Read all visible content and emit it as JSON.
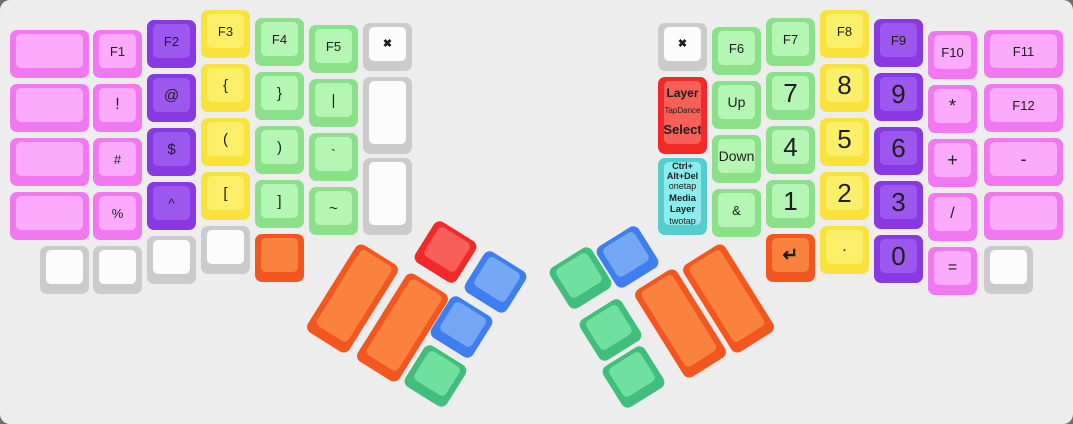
{
  "board": {
    "width": 1073,
    "height": 424,
    "bg": "#ededed",
    "page_bg": "#6e6e6e",
    "radius": 10,
    "legend_color": "#1e1e1e"
  },
  "palette": {
    "pink": {
      "outer": "#f178f1",
      "inner": "#fcaafc"
    },
    "purple": {
      "outer": "#8939e2",
      "inner": "#9c57ee"
    },
    "yellow": {
      "outer": "#f7e33b",
      "inner": "#fbef69"
    },
    "green": {
      "outer": "#8ae18a",
      "inner": "#b5f6b5"
    },
    "white": {
      "outer": "#cbcbcb",
      "inner": "#fcfcfc"
    },
    "orange": {
      "outer": "#f3561e",
      "inner": "#f8823e"
    },
    "red": {
      "outer": "#f22929",
      "inner": "#f75f58"
    },
    "blue": {
      "outer": "#3f7eee",
      "inner": "#74a7f4"
    },
    "tgreen": {
      "outer": "#41bd7c",
      "inner": "#70e09f"
    },
    "cyan": {
      "outer": "#55cdcd",
      "inner": "#8cebeb"
    }
  },
  "keys": [
    {
      "n": "key-blank-l1-r1",
      "c": "pink",
      "x": 10,
      "y": 30,
      "w": 79
    },
    {
      "n": "key-blank-l1-r2",
      "c": "pink",
      "x": 10,
      "y": 84,
      "w": 79
    },
    {
      "n": "key-blank-l1-r3",
      "c": "pink",
      "x": 10,
      "y": 138,
      "w": 79
    },
    {
      "n": "key-blank-l1-r4",
      "c": "pink",
      "x": 10,
      "y": 192,
      "w": 79
    },
    {
      "n": "key-blank-l1-bottom",
      "c": "white",
      "x": 40,
      "y": 246
    },
    {
      "n": "key-f1",
      "c": "pink",
      "x": 93,
      "y": 30,
      "l": "F1",
      "fs": 13
    },
    {
      "n": "key-exclamation",
      "c": "pink",
      "x": 93,
      "y": 84,
      "l": "!",
      "fs": 16
    },
    {
      "n": "key-hash",
      "c": "pink",
      "x": 93,
      "y": 138,
      "l": "#",
      "fs": 13
    },
    {
      "n": "key-percent",
      "c": "pink",
      "x": 93,
      "y": 192,
      "l": "%",
      "fs": 13
    },
    {
      "n": "key-blank-l2-bottom",
      "c": "white",
      "x": 93,
      "y": 246
    },
    {
      "n": "key-f2",
      "c": "purple",
      "x": 147,
      "y": 20,
      "l": "F2",
      "fs": 13
    },
    {
      "n": "key-at",
      "c": "purple",
      "x": 147,
      "y": 74,
      "l": "@",
      "fs": 15
    },
    {
      "n": "key-dollar",
      "c": "purple",
      "x": 147,
      "y": 128,
      "l": "$",
      "fs": 15
    },
    {
      "n": "key-caret",
      "c": "purple",
      "x": 147,
      "y": 182,
      "l": "^",
      "fs": 13
    },
    {
      "n": "key-blank-l3-bottom",
      "c": "white",
      "x": 147,
      "y": 236
    },
    {
      "n": "key-f3",
      "c": "yellow",
      "x": 201,
      "y": 10,
      "l": "F3",
      "fs": 13
    },
    {
      "n": "key-brace-open",
      "c": "yellow",
      "x": 201,
      "y": 64,
      "l": "{",
      "fs": 15
    },
    {
      "n": "key-paren-open",
      "c": "yellow",
      "x": 201,
      "y": 118,
      "l": "(",
      "fs": 15
    },
    {
      "n": "key-bracket-open",
      "c": "yellow",
      "x": 201,
      "y": 172,
      "l": "[",
      "fs": 15
    },
    {
      "n": "key-blank-l4-bottom",
      "c": "white",
      "x": 201,
      "y": 226
    },
    {
      "n": "key-f4",
      "c": "green",
      "x": 255,
      "y": 18,
      "l": "F4",
      "fs": 13
    },
    {
      "n": "key-brace-close",
      "c": "green",
      "x": 255,
      "y": 72,
      "l": "}",
      "fs": 15
    },
    {
      "n": "key-paren-close",
      "c": "green",
      "x": 255,
      "y": 126,
      "l": ")",
      "fs": 15
    },
    {
      "n": "key-bracket-close",
      "c": "green",
      "x": 255,
      "y": 180,
      "l": "]",
      "fs": 15
    },
    {
      "n": "key-blank-orange-left",
      "c": "orange",
      "x": 255,
      "y": 234
    },
    {
      "n": "key-f5",
      "c": "green",
      "x": 309,
      "y": 25,
      "l": "F5",
      "fs": 13
    },
    {
      "n": "key-pipe",
      "c": "green",
      "x": 309,
      "y": 79,
      "l": "|",
      "fs": 15
    },
    {
      "n": "key-backtick",
      "c": "green",
      "x": 309,
      "y": 133,
      "l": "`",
      "fs": 14
    },
    {
      "n": "key-tilde",
      "c": "green",
      "x": 309,
      "y": 187,
      "l": "~",
      "fs": 15
    },
    {
      "n": "key-close-left",
      "c": "white",
      "x": 363,
      "y": 23,
      "l": "✖",
      "fs": 11,
      "b": 1
    },
    {
      "n": "key-blank-tall-1",
      "c": "white",
      "x": 363,
      "y": 77,
      "h": 77
    },
    {
      "n": "key-blank-tall-2",
      "c": "white",
      "x": 363,
      "y": 158,
      "h": 77
    },
    {
      "n": "key-thumb-l-orange-1",
      "c": "orange",
      "x": 328,
      "y": 247,
      "h": 103,
      "r": 32
    },
    {
      "n": "key-thumb-l-orange-2",
      "c": "orange",
      "x": 378,
      "y": 276,
      "h": 103,
      "r": 32
    },
    {
      "n": "key-thumb-l-red",
      "c": "red",
      "x": 421,
      "y": 228,
      "r": 32
    },
    {
      "n": "key-thumb-l-blue-1",
      "c": "blue",
      "x": 471,
      "y": 258,
      "r": 32
    },
    {
      "n": "key-thumb-l-blue-2",
      "c": "blue",
      "x": 437,
      "y": 303,
      "r": 32
    },
    {
      "n": "key-thumb-l-green",
      "c": "tgreen",
      "x": 411,
      "y": 352,
      "r": 32
    },
    {
      "n": "key-thumb-r-blue",
      "c": "blue",
      "x": 603,
      "y": 233,
      "r": -32
    },
    {
      "n": "key-thumb-r-green-1",
      "c": "tgreen",
      "x": 556,
      "y": 254,
      "r": -32
    },
    {
      "n": "key-thumb-r-green-2",
      "c": "tgreen",
      "x": 586,
      "y": 306,
      "r": -32
    },
    {
      "n": "key-thumb-r-green-3",
      "c": "tgreen",
      "x": 609,
      "y": 353,
      "r": -32
    },
    {
      "n": "key-thumb-r-orange-1",
      "c": "orange",
      "x": 656,
      "y": 272,
      "h": 103,
      "r": -32
    },
    {
      "n": "key-thumb-r-orange-2",
      "c": "orange",
      "x": 704,
      "y": 247,
      "h": 103,
      "r": -32
    },
    {
      "n": "key-close-right",
      "c": "white",
      "x": 658,
      "y": 23,
      "l": "✖",
      "fs": 11,
      "b": 1
    },
    {
      "n": "key-layer-tapdance-select",
      "c": "red",
      "x": 658,
      "y": 77,
      "h": 77,
      "spread": 1,
      "lines": [
        {
          "t": "Layer",
          "fs": 12,
          "b": 1
        },
        {
          "t": "TapDance",
          "fs": 8
        },
        {
          "t": "Select",
          "fs": 13,
          "b": 1
        }
      ]
    },
    {
      "n": "key-ctrl-alt-del-media-layer",
      "c": "cyan",
      "x": 658,
      "y": 158,
      "h": 77,
      "lines": [
        {
          "t": "Ctrl+",
          "fs": 9,
          "b": 1
        },
        {
          "t": "Alt+Del",
          "fs": 9,
          "b": 1
        },
        {
          "t": "onetap",
          "fs": 9
        },
        {
          "t": "Media",
          "fs": 9.5,
          "b": 1,
          "gap": 1
        },
        {
          "t": "Layer",
          "fs": 9.5,
          "b": 1
        },
        {
          "t": "twotap",
          "fs": 9
        }
      ]
    },
    {
      "n": "key-f6",
      "c": "green",
      "x": 712,
      "y": 27,
      "l": "F6",
      "fs": 13
    },
    {
      "n": "key-up",
      "c": "green",
      "x": 712,
      "y": 81,
      "l": "Up",
      "fs": 14
    },
    {
      "n": "key-down",
      "c": "green",
      "x": 712,
      "y": 135,
      "l": "Down",
      "fs": 14
    },
    {
      "n": "key-ampersand",
      "c": "green",
      "x": 712,
      "y": 189,
      "l": "&",
      "fs": 13
    },
    {
      "n": "key-f7",
      "c": "green",
      "x": 766,
      "y": 18,
      "l": "F7",
      "fs": 13
    },
    {
      "n": "key-7",
      "c": "green",
      "x": 766,
      "y": 72,
      "l": "7",
      "fs": 26
    },
    {
      "n": "key-4",
      "c": "green",
      "x": 766,
      "y": 126,
      "l": "4",
      "fs": 26
    },
    {
      "n": "key-1",
      "c": "green",
      "x": 766,
      "y": 180,
      "l": "1",
      "fs": 26
    },
    {
      "n": "key-enter",
      "c": "orange",
      "x": 766,
      "y": 234,
      "l": "↵",
      "fs": 19,
      "b": 1
    },
    {
      "n": "key-f8",
      "c": "yellow",
      "x": 820,
      "y": 10,
      "l": "F8",
      "fs": 13
    },
    {
      "n": "key-8",
      "c": "yellow",
      "x": 820,
      "y": 64,
      "l": "8",
      "fs": 26
    },
    {
      "n": "key-5",
      "c": "yellow",
      "x": 820,
      "y": 118,
      "l": "5",
      "fs": 26
    },
    {
      "n": "key-2",
      "c": "yellow",
      "x": 820,
      "y": 172,
      "l": "2",
      "fs": 26
    },
    {
      "n": "key-period",
      "c": "yellow",
      "x": 820,
      "y": 226,
      "l": ".",
      "fs": 16
    },
    {
      "n": "key-f9",
      "c": "purple",
      "x": 874,
      "y": 19,
      "l": "F9",
      "fs": 13
    },
    {
      "n": "key-9",
      "c": "purple",
      "x": 874,
      "y": 73,
      "l": "9",
      "fs": 26
    },
    {
      "n": "key-6",
      "c": "purple",
      "x": 874,
      "y": 127,
      "l": "6",
      "fs": 26
    },
    {
      "n": "key-3",
      "c": "purple",
      "x": 874,
      "y": 181,
      "l": "3",
      "fs": 26
    },
    {
      "n": "key-0",
      "c": "purple",
      "x": 874,
      "y": 235,
      "l": "0",
      "fs": 26
    },
    {
      "n": "key-f10",
      "c": "pink",
      "x": 928,
      "y": 31,
      "l": "F10",
      "fs": 13
    },
    {
      "n": "key-asterisk",
      "c": "pink",
      "x": 928,
      "y": 85,
      "l": "*",
      "fs": 18
    },
    {
      "n": "key-plus",
      "c": "pink",
      "x": 928,
      "y": 139,
      "l": "+",
      "fs": 18
    },
    {
      "n": "key-slash",
      "c": "pink",
      "x": 928,
      "y": 193,
      "l": "/",
      "fs": 16
    },
    {
      "n": "key-equals",
      "c": "pink",
      "x": 928,
      "y": 247,
      "l": "=",
      "fs": 16
    },
    {
      "n": "key-f11",
      "c": "pink",
      "x": 984,
      "y": 30,
      "w": 79,
      "l": "F11",
      "fs": 13
    },
    {
      "n": "key-f12",
      "c": "pink",
      "x": 984,
      "y": 84,
      "w": 79,
      "l": "F12",
      "fs": 13
    },
    {
      "n": "key-minus",
      "c": "pink",
      "x": 984,
      "y": 138,
      "w": 79,
      "l": "-",
      "fs": 18
    },
    {
      "n": "key-blank-r7",
      "c": "pink",
      "x": 984,
      "y": 192,
      "w": 79
    },
    {
      "n": "key-blank-r7-bottom",
      "c": "white",
      "x": 984,
      "y": 246
    }
  ]
}
